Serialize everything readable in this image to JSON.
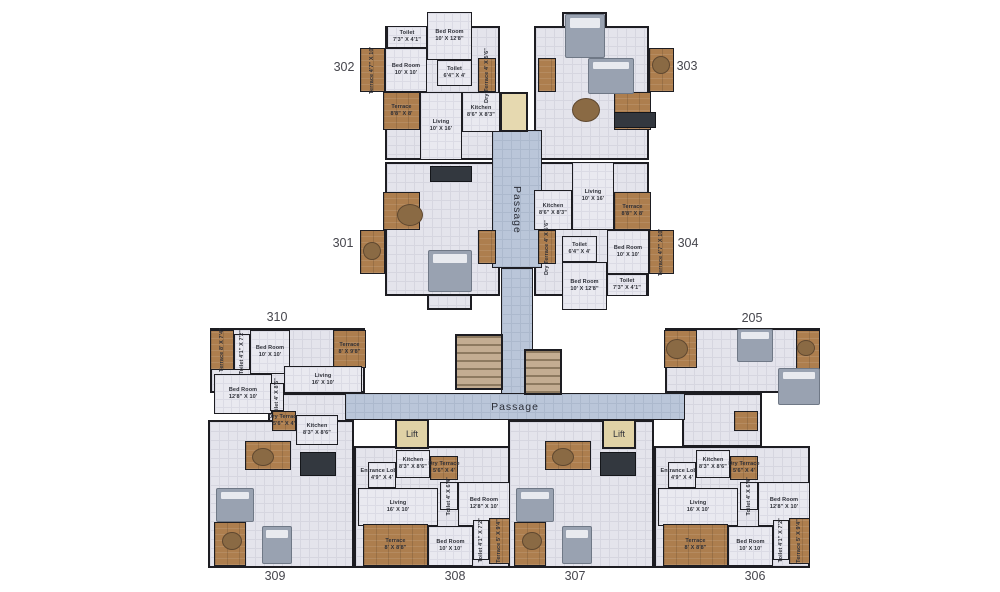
{
  "palette": {
    "background": "#ffffff",
    "wall": "#1d1d22",
    "floor": "#e4e4ec",
    "corridor_blue": "#bac6d9",
    "terrace_brown": "#ad7e4e",
    "lift_tan": "#e0d2a6",
    "stair_tan": "#c3ad92",
    "label_text": "#2e3038",
    "unit_number_text": "#46464d"
  },
  "plan": {
    "width": 1000,
    "height": 592,
    "unit_numbers": [
      {
        "label": "302",
        "x": 344,
        "y": 68
      },
      {
        "label": "303",
        "x": 687,
        "y": 67
      },
      {
        "label": "301",
        "x": 343,
        "y": 244
      },
      {
        "label": "304",
        "x": 688,
        "y": 244
      },
      {
        "label": "310",
        "x": 277,
        "y": 318
      },
      {
        "label": "205",
        "x": 752,
        "y": 319
      },
      {
        "label": "309",
        "x": 275,
        "y": 577
      },
      {
        "label": "308",
        "x": 455,
        "y": 577
      },
      {
        "label": "307",
        "x": 575,
        "y": 577
      },
      {
        "label": "306",
        "x": 755,
        "y": 577
      }
    ],
    "passages": [
      {
        "id": "upper-passage",
        "label": "Passage",
        "orientation": "vertical",
        "x": 496,
        "y": 158,
        "w": 42,
        "h": 104
      },
      {
        "id": "lower-passage",
        "label": "Passage",
        "orientation": "horizontal",
        "x": 455,
        "y": 396,
        "w": 120,
        "h": 22
      }
    ],
    "corridors": [
      {
        "id": "upper-corridor-wide",
        "x": 492,
        "y": 130,
        "w": 50,
        "h": 138
      },
      {
        "id": "upper-corridor-narrow",
        "x": 501,
        "y": 268,
        "w": 32,
        "h": 127
      },
      {
        "id": "lower-corridor-band",
        "x": 345,
        "y": 393,
        "w": 340,
        "h": 27
      }
    ],
    "lifts": [
      {
        "label": "Lift",
        "x": 395,
        "y": 419,
        "w": 34,
        "h": 30
      },
      {
        "label": "Lift",
        "x": 602,
        "y": 419,
        "w": 34,
        "h": 30
      }
    ],
    "stairs": [
      {
        "x": 455,
        "y": 334,
        "w": 48,
        "h": 56
      },
      {
        "x": 524,
        "y": 349,
        "w": 38,
        "h": 46
      }
    ],
    "shaft": {
      "x": 500,
      "y": 92,
      "w": 28,
      "h": 40
    },
    "bases": [
      {
        "unit": "302",
        "x": 385,
        "y": 26,
        "w": 115,
        "h": 134
      },
      {
        "unit": "302",
        "x": 427,
        "y": 12,
        "w": 45,
        "h": 16
      },
      {
        "unit": "303",
        "x": 534,
        "y": 26,
        "w": 115,
        "h": 134
      },
      {
        "unit": "303",
        "x": 562,
        "y": 12,
        "w": 45,
        "h": 16
      },
      {
        "unit": "301",
        "x": 385,
        "y": 162,
        "w": 115,
        "h": 134
      },
      {
        "unit": "301",
        "x": 427,
        "y": 294,
        "w": 45,
        "h": 16
      },
      {
        "unit": "304",
        "x": 534,
        "y": 162,
        "w": 115,
        "h": 134
      },
      {
        "unit": "304",
        "x": 562,
        "y": 294,
        "w": 45,
        "h": 16
      },
      {
        "unit": "310",
        "x": 210,
        "y": 328,
        "w": 155,
        "h": 65
      },
      {
        "unit": "310",
        "x": 268,
        "y": 393,
        "w": 80,
        "h": 54
      },
      {
        "unit": "205",
        "x": 665,
        "y": 328,
        "w": 155,
        "h": 65
      },
      {
        "unit": "205",
        "x": 682,
        "y": 393,
        "w": 80,
        "h": 54
      },
      {
        "unit": "309",
        "x": 208,
        "y": 420,
        "w": 146,
        "h": 148
      },
      {
        "unit": "308",
        "x": 354,
        "y": 446,
        "w": 156,
        "h": 122
      },
      {
        "unit": "307",
        "x": 508,
        "y": 420,
        "w": 146,
        "h": 148
      },
      {
        "unit": "306",
        "x": 654,
        "y": 446,
        "w": 156,
        "h": 122
      }
    ],
    "rooms": [
      {
        "unit": "302",
        "name": "Terrace",
        "dims": "4'7\" X 10'",
        "x": 360,
        "y": 48,
        "w": 25,
        "h": 44,
        "kind": "terrace",
        "vertical": true
      },
      {
        "unit": "302",
        "name": "Bed Room",
        "dims": "10' X 10'",
        "x": 385,
        "y": 48,
        "w": 42,
        "h": 44,
        "kind": "floor",
        "vertical": false
      },
      {
        "unit": "302",
        "name": "Toilet",
        "dims": "7'3\" X 4'1\"",
        "x": 387,
        "y": 26,
        "w": 40,
        "h": 22,
        "kind": "floor",
        "vertical": false
      },
      {
        "unit": "302",
        "name": "Bed Room",
        "dims": "10' X 12'8\"",
        "x": 427,
        "y": 12,
        "w": 45,
        "h": 48,
        "kind": "floor",
        "vertical": false
      },
      {
        "unit": "302",
        "name": "Toilet",
        "dims": "6'4\" X 4'",
        "x": 437,
        "y": 60,
        "w": 35,
        "h": 26,
        "kind": "floor",
        "vertical": false
      },
      {
        "unit": "302",
        "name": "Terrace",
        "dims": "8'8\" X 8'",
        "x": 383,
        "y": 92,
        "w": 37,
        "h": 38,
        "kind": "terrace",
        "vertical": false
      },
      {
        "unit": "302",
        "name": "Living",
        "dims": "10' X 16'",
        "x": 420,
        "y": 92,
        "w": 42,
        "h": 68,
        "kind": "floor",
        "vertical": false
      },
      {
        "unit": "302",
        "name": "Kitchen",
        "dims": "8'6\" X 8'3\"",
        "x": 462,
        "y": 92,
        "w": 38,
        "h": 40,
        "kind": "floor",
        "vertical": false
      },
      {
        "unit": "302",
        "name": "Dry Terrace",
        "dims": "4' X 5'6\"",
        "x": 478,
        "y": 58,
        "w": 18,
        "h": 34,
        "kind": "terrace",
        "vertical": true
      },
      {
        "unit": "304",
        "name": "Terrace",
        "dims": "4'7\" X 10'",
        "x": 649,
        "y": 230,
        "w": 25,
        "h": 44,
        "kind": "terrace",
        "vertical": true
      },
      {
        "unit": "304",
        "name": "Bed Room",
        "dims": "10' X 10'",
        "x": 607,
        "y": 230,
        "w": 42,
        "h": 44,
        "kind": "floor",
        "vertical": false
      },
      {
        "unit": "304",
        "name": "Toilet",
        "dims": "7'3\" X 4'1\"",
        "x": 607,
        "y": 274,
        "w": 40,
        "h": 22,
        "kind": "floor",
        "vertical": false
      },
      {
        "unit": "304",
        "name": "Bed Room",
        "dims": "10' X 12'8\"",
        "x": 562,
        "y": 262,
        "w": 45,
        "h": 48,
        "kind": "floor",
        "vertical": false
      },
      {
        "unit": "304",
        "name": "Toilet",
        "dims": "6'4\" X 4'",
        "x": 562,
        "y": 236,
        "w": 35,
        "h": 26,
        "kind": "floor",
        "vertical": false
      },
      {
        "unit": "304",
        "name": "Terrace",
        "dims": "8'8\" X 8'",
        "x": 614,
        "y": 192,
        "w": 37,
        "h": 38,
        "kind": "terrace",
        "vertical": false
      },
      {
        "unit": "304",
        "name": "Living",
        "dims": "10' X 16'",
        "x": 572,
        "y": 162,
        "w": 42,
        "h": 68,
        "kind": "floor",
        "vertical": false
      },
      {
        "unit": "304",
        "name": "Kitchen",
        "dims": "8'6\" X 8'3\"",
        "x": 534,
        "y": 190,
        "w": 38,
        "h": 40,
        "kind": "floor",
        "vertical": false
      },
      {
        "unit": "304",
        "name": "Dry Terrace",
        "dims": "4' X 5'6\"",
        "x": 538,
        "y": 230,
        "w": 18,
        "h": 34,
        "kind": "terrace",
        "vertical": true
      },
      {
        "unit": "310",
        "name": "Terrace",
        "dims": "8' X 7'4\"",
        "x": 210,
        "y": 330,
        "w": 24,
        "h": 40,
        "kind": "terrace",
        "vertical": true
      },
      {
        "unit": "310",
        "name": "Toilet",
        "dims": "4'1\" X 7'2\"",
        "x": 234,
        "y": 334,
        "w": 16,
        "h": 36,
        "kind": "floor",
        "vertical": true
      },
      {
        "unit": "310",
        "name": "Bed Room",
        "dims": "10' X 10'",
        "x": 250,
        "y": 330,
        "w": 40,
        "h": 44,
        "kind": "floor",
        "vertical": false
      },
      {
        "unit": "310",
        "name": "Terrace",
        "dims": "8' X 9'8\"",
        "x": 333,
        "y": 330,
        "w": 33,
        "h": 38,
        "kind": "terrace",
        "vertical": false
      },
      {
        "unit": "310",
        "name": "Bed Room",
        "dims": "12'8\" X 10'",
        "x": 214,
        "y": 374,
        "w": 58,
        "h": 40,
        "kind": "floor",
        "vertical": false
      },
      {
        "unit": "310",
        "name": "Toilet",
        "dims": "4' X 8'6\"",
        "x": 270,
        "y": 383,
        "w": 14,
        "h": 28,
        "kind": "floor",
        "vertical": true
      },
      {
        "unit": "310",
        "name": "Living",
        "dims": "16' X 10'",
        "x": 284,
        "y": 366,
        "w": 78,
        "h": 27,
        "kind": "floor",
        "vertical": false
      },
      {
        "unit": "310",
        "name": "Dry Terrace",
        "dims": "5'6\" X 4'",
        "x": 272,
        "y": 411,
        "w": 24,
        "h": 20,
        "kind": "terrace",
        "vertical": false
      },
      {
        "unit": "310",
        "name": "Kitchen",
        "dims": "8'3\" X 8'6\"",
        "x": 296,
        "y": 415,
        "w": 42,
        "h": 30,
        "kind": "floor",
        "vertical": false
      },
      {
        "unit": "308",
        "name": "Entrance Lobby",
        "dims": "4'9\" X 4'",
        "x": 368,
        "y": 462,
        "w": 28,
        "h": 26,
        "kind": "floor",
        "vertical": false
      },
      {
        "unit": "308",
        "name": "Kitchen",
        "dims": "8'3\" X 8'6\"",
        "x": 396,
        "y": 450,
        "w": 34,
        "h": 28,
        "kind": "floor",
        "vertical": false
      },
      {
        "unit": "308",
        "name": "Dry Terrace",
        "dims": "5'6\" X 4'",
        "x": 430,
        "y": 456,
        "w": 28,
        "h": 24,
        "kind": "terrace",
        "vertical": false
      },
      {
        "unit": "308",
        "name": "Toilet",
        "dims": "4' X 6'4\"",
        "x": 440,
        "y": 482,
        "w": 18,
        "h": 28,
        "kind": "floor",
        "vertical": true
      },
      {
        "unit": "308",
        "name": "Living",
        "dims": "16' X 10'",
        "x": 358,
        "y": 488,
        "w": 80,
        "h": 38,
        "kind": "floor",
        "vertical": false
      },
      {
        "unit": "308",
        "name": "Bed Room",
        "dims": "12'8\" X 10'",
        "x": 458,
        "y": 482,
        "w": 52,
        "h": 44,
        "kind": "floor",
        "vertical": false
      },
      {
        "unit": "308",
        "name": "Bed Room",
        "dims": "10' X 10'",
        "x": 428,
        "y": 526,
        "w": 45,
        "h": 40,
        "kind": "floor",
        "vertical": false
      },
      {
        "unit": "308",
        "name": "Toilet",
        "dims": "4'1\" X 7'2\"",
        "x": 473,
        "y": 520,
        "w": 16,
        "h": 40,
        "kind": "floor",
        "vertical": true
      },
      {
        "unit": "308",
        "name": "Terrace",
        "dims": "5' X 9'4\"",
        "x": 489,
        "y": 518,
        "w": 21,
        "h": 46,
        "kind": "terrace",
        "vertical": true
      },
      {
        "unit": "308",
        "name": "Terrace",
        "dims": "8' X 8'8\"",
        "x": 363,
        "y": 524,
        "w": 65,
        "h": 42,
        "kind": "terrace",
        "vertical": false
      },
      {
        "unit": "306",
        "name": "Entrance Lobby",
        "dims": "4'9\" X 4'",
        "x": 668,
        "y": 462,
        "w": 28,
        "h": 26,
        "kind": "floor",
        "vertical": false
      },
      {
        "unit": "306",
        "name": "Kitchen",
        "dims": "8'3\" X 8'6\"",
        "x": 696,
        "y": 450,
        "w": 34,
        "h": 28,
        "kind": "floor",
        "vertical": false
      },
      {
        "unit": "306",
        "name": "Dry Terrace",
        "dims": "5'6\" X 4'",
        "x": 730,
        "y": 456,
        "w": 28,
        "h": 24,
        "kind": "terrace",
        "vertical": false
      },
      {
        "unit": "306",
        "name": "Toilet",
        "dims": "4' X 6'4\"",
        "x": 740,
        "y": 482,
        "w": 18,
        "h": 28,
        "kind": "floor",
        "vertical": true
      },
      {
        "unit": "306",
        "name": "Living",
        "dims": "16' X 10'",
        "x": 658,
        "y": 488,
        "w": 80,
        "h": 38,
        "kind": "floor",
        "vertical": false
      },
      {
        "unit": "306",
        "name": "Bed Room",
        "dims": "12'8\" X 10'",
        "x": 758,
        "y": 482,
        "w": 52,
        "h": 44,
        "kind": "floor",
        "vertical": false
      },
      {
        "unit": "306",
        "name": "Bed Room",
        "dims": "10' X 10'",
        "x": 728,
        "y": 526,
        "w": 45,
        "h": 40,
        "kind": "floor",
        "vertical": false
      },
      {
        "unit": "306",
        "name": "Toilet",
        "dims": "4'1\" X 7'2\"",
        "x": 773,
        "y": 520,
        "w": 16,
        "h": 40,
        "kind": "floor",
        "vertical": true
      },
      {
        "unit": "306",
        "name": "Terrace",
        "dims": "5' X 9'4\"",
        "x": 789,
        "y": 518,
        "w": 21,
        "h": 46,
        "kind": "terrace",
        "vertical": true
      },
      {
        "unit": "306",
        "name": "Terrace",
        "dims": "8' X 8'8\"",
        "x": 663,
        "y": 524,
        "w": 65,
        "h": 42,
        "kind": "terrace",
        "vertical": false
      }
    ],
    "terrace_blocks": [
      {
        "unit": "303",
        "x": 649,
        "y": 48,
        "w": 25,
        "h": 44
      },
      {
        "unit": "303",
        "x": 614,
        "y": 92,
        "w": 37,
        "h": 38
      },
      {
        "unit": "303",
        "x": 538,
        "y": 58,
        "w": 18,
        "h": 34
      },
      {
        "unit": "301",
        "x": 360,
        "y": 230,
        "w": 25,
        "h": 44
      },
      {
        "unit": "301",
        "x": 383,
        "y": 192,
        "w": 37,
        "h": 38
      },
      {
        "unit": "301",
        "x": 478,
        "y": 230,
        "w": 18,
        "h": 34
      },
      {
        "unit": "205",
        "x": 796,
        "y": 330,
        "w": 24,
        "h": 40
      },
      {
        "unit": "205",
        "x": 664,
        "y": 330,
        "w": 33,
        "h": 38
      },
      {
        "unit": "205",
        "x": 734,
        "y": 411,
        "w": 24,
        "h": 20
      },
      {
        "unit": "309",
        "x": 245,
        "y": 441,
        "w": 46,
        "h": 29
      },
      {
        "unit": "309",
        "x": 214,
        "y": 522,
        "w": 32,
        "h": 44
      },
      {
        "unit": "307",
        "x": 545,
        "y": 441,
        "w": 46,
        "h": 29
      },
      {
        "unit": "307",
        "x": 514,
        "y": 522,
        "w": 32,
        "h": 44
      }
    ],
    "furniture": [
      {
        "unit": "303",
        "type": "bed",
        "x": 565,
        "y": 14,
        "w": 40,
        "h": 44
      },
      {
        "unit": "303",
        "type": "bed",
        "x": 588,
        "y": 58,
        "w": 46,
        "h": 36
      },
      {
        "unit": "303",
        "type": "table",
        "x": 652,
        "y": 56,
        "w": 18,
        "h": 18
      },
      {
        "unit": "303",
        "type": "table",
        "x": 572,
        "y": 98,
        "w": 28,
        "h": 24
      },
      {
        "unit": "303",
        "type": "counter",
        "x": 614,
        "y": 112,
        "w": 42,
        "h": 16
      },
      {
        "unit": "301",
        "type": "counter",
        "x": 430,
        "y": 166,
        "w": 42,
        "h": 16
      },
      {
        "unit": "301",
        "type": "table",
        "x": 397,
        "y": 204,
        "w": 26,
        "h": 22
      },
      {
        "unit": "301",
        "type": "bed",
        "x": 428,
        "y": 250,
        "w": 44,
        "h": 42
      },
      {
        "unit": "301",
        "type": "table",
        "x": 363,
        "y": 242,
        "w": 18,
        "h": 18
      },
      {
        "unit": "205",
        "type": "bed",
        "x": 737,
        "y": 329,
        "w": 36,
        "h": 33
      },
      {
        "unit": "205",
        "type": "bed",
        "x": 778,
        "y": 368,
        "w": 42,
        "h": 37
      },
      {
        "unit": "205",
        "type": "table",
        "x": 666,
        "y": 339,
        "w": 22,
        "h": 20
      },
      {
        "unit": "205",
        "type": "table",
        "x": 797,
        "y": 340,
        "w": 18,
        "h": 16
      },
      {
        "unit": "309",
        "type": "counter",
        "x": 300,
        "y": 452,
        "w": 36,
        "h": 24
      },
      {
        "unit": "309",
        "type": "table",
        "x": 252,
        "y": 448,
        "w": 22,
        "h": 18
      },
      {
        "unit": "309",
        "type": "bed",
        "x": 216,
        "y": 488,
        "w": 38,
        "h": 34
      },
      {
        "unit": "309",
        "type": "bed",
        "x": 262,
        "y": 526,
        "w": 30,
        "h": 38
      },
      {
        "unit": "309",
        "type": "table",
        "x": 222,
        "y": 532,
        "w": 20,
        "h": 18
      },
      {
        "unit": "307",
        "type": "counter",
        "x": 600,
        "y": 452,
        "w": 36,
        "h": 24
      },
      {
        "unit": "307",
        "type": "table",
        "x": 552,
        "y": 448,
        "w": 22,
        "h": 18
      },
      {
        "unit": "307",
        "type": "bed",
        "x": 516,
        "y": 488,
        "w": 38,
        "h": 34
      },
      {
        "unit": "307",
        "type": "bed",
        "x": 562,
        "y": 526,
        "w": 30,
        "h": 38
      },
      {
        "unit": "307",
        "type": "table",
        "x": 522,
        "y": 532,
        "w": 20,
        "h": 18
      }
    ]
  }
}
